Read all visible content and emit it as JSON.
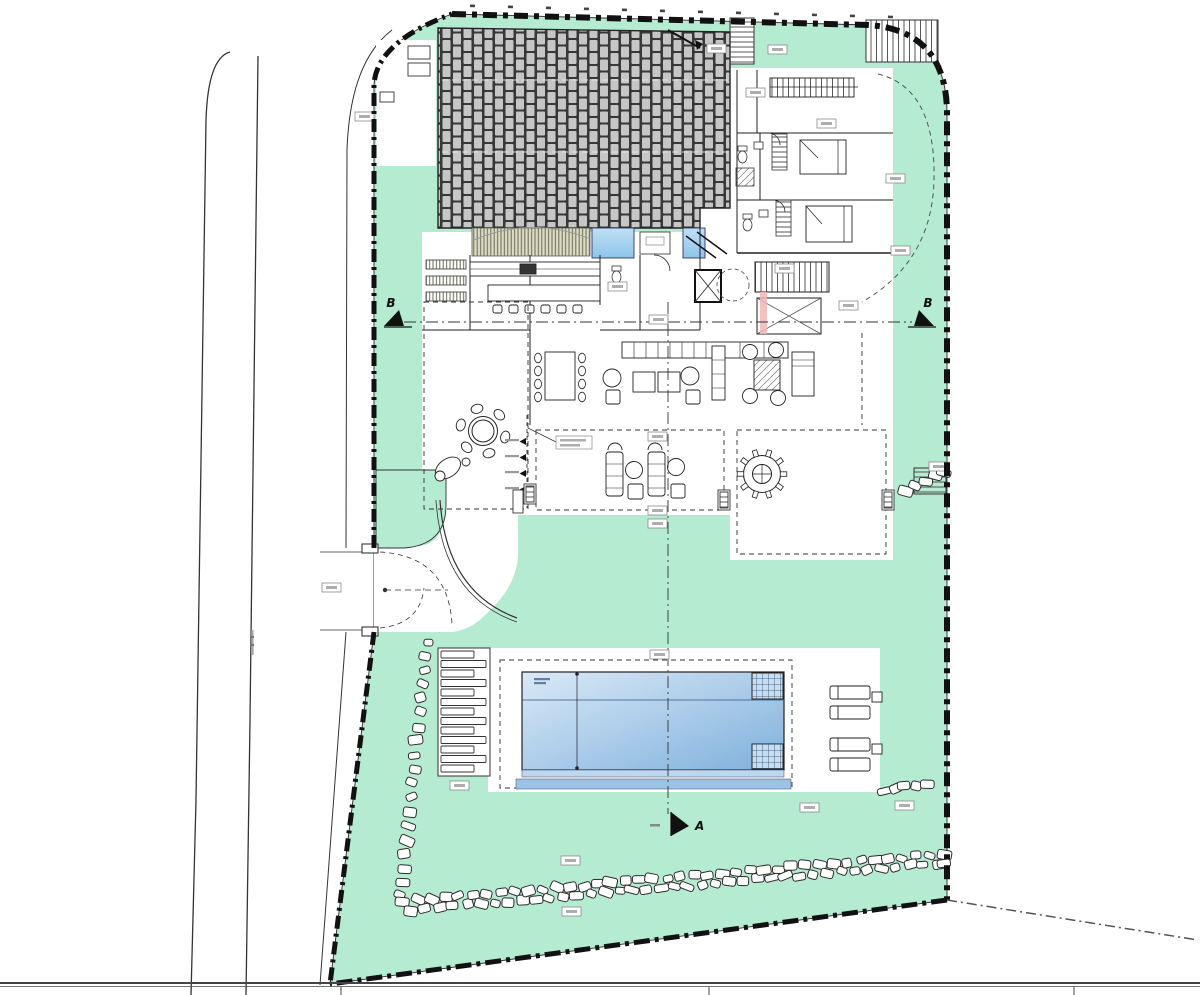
{
  "drawing": {
    "kind": "architectural site plan",
    "section_markers": {
      "left": "B",
      "right": "B",
      "bottom": "A"
    }
  },
  "colors": {
    "site_green": "#b5ebd1",
    "line": "#1a1a1a",
    "wall": "#111111",
    "pool_light": "#d9e9f7",
    "pool_dark": "#7fb0dc",
    "pool_edge1": "#bcd7ee",
    "pool_edge2": "#9cc3e6",
    "roof_grout": "#383838",
    "roof_tile": "#c6c6c6",
    "pergola_bg": "#dcdcc6",
    "pergola_line": "#6a6a52",
    "water_feature_1": "#bfe0f5",
    "water_feature_2": "#8ec4ea",
    "stair_pink": "#f2b6b6",
    "label_fill": "#ffffff",
    "label_stroke": "#8a8a8a",
    "label_smudge": "#aeaeae",
    "stone_stroke": "#2b2b2b"
  }
}
